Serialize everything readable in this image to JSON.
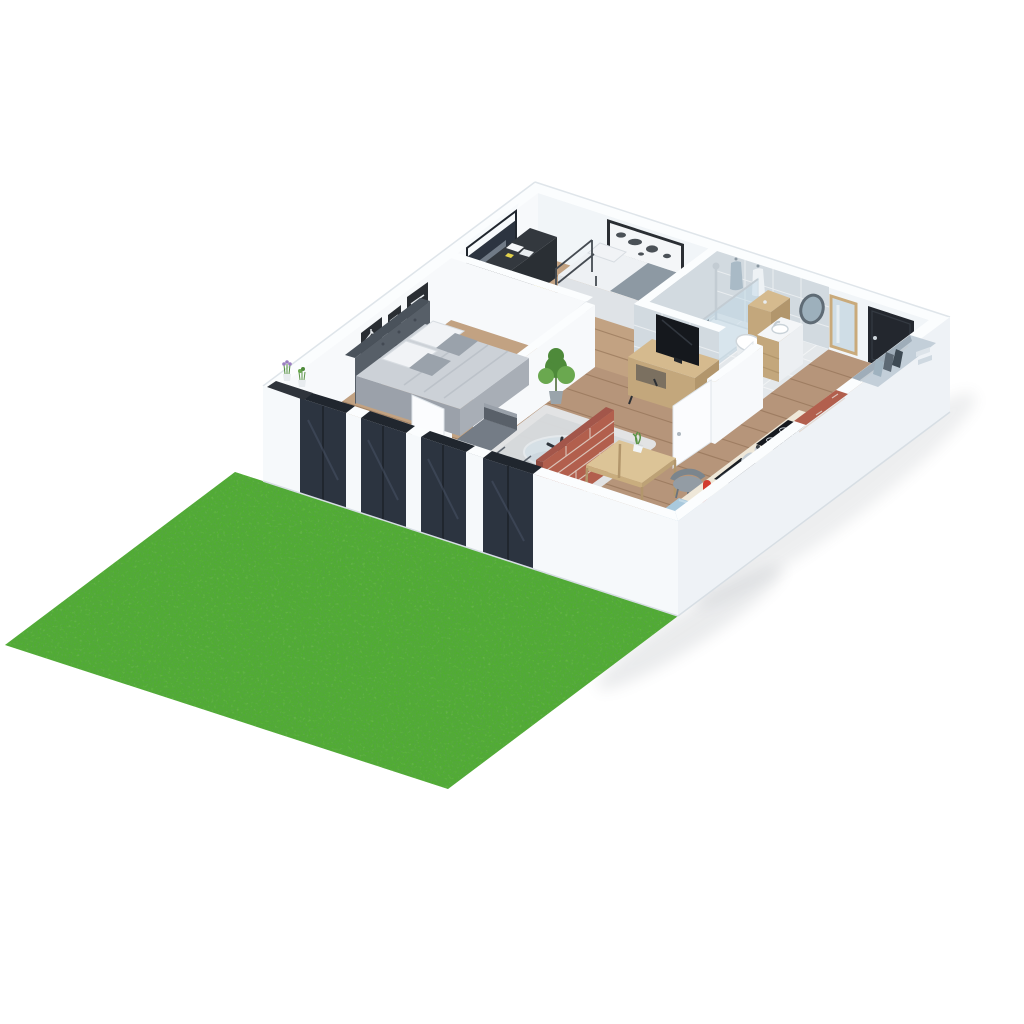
{
  "scene": {
    "type": "3d-isometric-cutaway-floor-plan-render",
    "setting": "one-bedroom apartment model on white background with green garden lawn at lower left",
    "rooms": [
      {
        "name": "master-bedroom",
        "items": [
          "double-bed",
          "tufted-headboard",
          "gray-duvet",
          "white-pillows",
          "gray-pillows",
          "three-black-wall-posters",
          "window-ledge-with-lavender-pots",
          "dark-sliding-glass-doors",
          "white-interior-door"
        ]
      },
      {
        "name": "second-bedroom",
        "items": [
          "single-metal-bed",
          "gray-blanket",
          "black-desk",
          "white-papers",
          "yellow-chair",
          "window-with-roller-blind",
          "white-dresser",
          "waste-bin",
          "wall-panel-box"
        ]
      },
      {
        "name": "bathroom",
        "items": [
          "walk-in-shower-tray",
          "glass-shower-screen",
          "chrome-shower-column",
          "toilet",
          "wooden-cistern-unit",
          "vanity-sink-unit",
          "oval-wall-mirror",
          "two-hanging-bathrobes",
          "tiled-walls"
        ]
      },
      {
        "name": "living-room",
        "items": [
          "corner-sofa",
          "shag-rug",
          "round-glass-coffee-table",
          "dark-table-ornament",
          "tv-sideboard",
          "flat-screen-tv",
          "tall-potted-plant"
        ]
      },
      {
        "name": "dining-area",
        "items": [
          "brick-partition-wall",
          "light-wood-dining-table",
          "table-plant",
          "two-gray-tub-chairs"
        ]
      },
      {
        "name": "kitchen",
        "items": [
          "counter-run-along-wall",
          "induction-cooktop",
          "moka-pot",
          "black-sink-with-faucet",
          "red-stand-mixer",
          "light-blue-cabinet-section",
          "brick-wall-segment"
        ]
      },
      {
        "name": "entrance-hall",
        "items": [
          "black-front-door",
          "tall-framed-mirror",
          "open-wardrobe-niche-with-rail-clothes-and-shelves",
          "white-open-doors"
        ]
      }
    ],
    "exterior": [
      "green-lawn",
      "white-cutaway-walls",
      "soft-ground-shadows"
    ]
  },
  "colors": {
    "lawn": "#4fae2d",
    "wallFaceLeft": "#f7f9fb",
    "wallFaceRight": "#f1f5f8",
    "wallTop": "#fbfdfe",
    "wallExterior": "#eef2f6",
    "wallExteriorBright": "#f6f9fb",
    "floorWood": "#b6957a",
    "bedroomWood": "#c2a282",
    "plankLine": "#8a6a4e",
    "tileFloor": "#e4e8eb",
    "tileWall": "#d2dae0",
    "glassDark": "#2c3440",
    "frameDark": "#20262e",
    "rug": "#d8dcdf",
    "rugEdge": "#e4e7e9",
    "sofaBody": "#434a53",
    "sofaSeat": "#747c86",
    "sofaBack": "#828a94",
    "sofaArm": "#596069",
    "sofaTopEdge": "#99a0a9",
    "duvet": "#ccd1d7",
    "duvetSide1": "#a8aeb6",
    "duvetSide2": "#9ba1aa",
    "pillowWhite": "#f1f3f6",
    "pillowGray": "#9aa2ab",
    "headboard": "#575f68",
    "headboardTop": "#4a525b",
    "mattress": "#eef1f4",
    "mattressSide": "#dfe3e7",
    "blanket": "#8d99a3",
    "blanketDark": "#7f8c97",
    "oak": "#d5ba8e",
    "oakShade": "#c3a77c",
    "oakDark": "#b2966c",
    "brick": "#b25f4d",
    "brickDark": "#8f4a40",
    "mortar": "#e0d5cb",
    "doorBlack": "#23272e",
    "tvBlack": "#15181d",
    "chairYellow": "#d6c13a",
    "chairYellowDark": "#c2ad30",
    "mixerRed": "#d23b2e",
    "counterCream": "#efe8d9",
    "counterEdge": "#ddd3c0",
    "counterBlue": "#a9c9dd",
    "mirrorGlass": "#cfdde6",
    "mirrorFrame": "#c9aa7b",
    "metal": "#c3ccd3",
    "plantGreen": "#4e8a3a",
    "plantGreenLight": "#6aa84f",
    "potGray": "#9aa4ab",
    "lavender": "#9b7fc0",
    "chairGray": "#939ca4",
    "chairGrayDark": "#7b858d",
    "mapFrame": "#2a2e33",
    "mapPaper": "#f4f6f8",
    "mapInk": "#4b5157",
    "shadow": "#5a646e"
  }
}
